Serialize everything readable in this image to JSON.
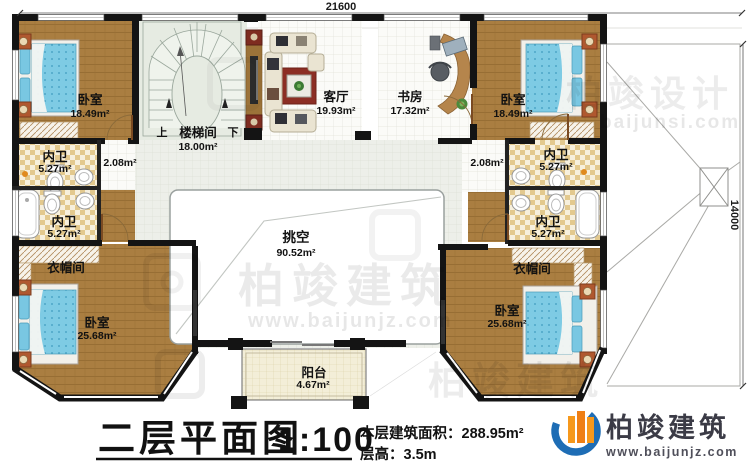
{
  "dimensions": {
    "top": "21600",
    "right": "14000"
  },
  "rooms": {
    "bedroom_tl": {
      "name": "卧室",
      "area": "18.49m²"
    },
    "bedroom_tr": {
      "name": "卧室",
      "area": "18.49m²"
    },
    "bedroom_bl": {
      "name": "卧室",
      "area": "25.68m²"
    },
    "bedroom_br": {
      "name": "卧室",
      "area": "25.68m²"
    },
    "stairwell": {
      "name": "楼梯间",
      "area": "18.00m²",
      "up": "上",
      "down": "下"
    },
    "living": {
      "name": "客厅",
      "area": "19.93m²"
    },
    "study": {
      "name": "书房",
      "area": "17.32m²"
    },
    "bath_tl": {
      "name": "内卫",
      "area": "5.27m²"
    },
    "bath_bl": {
      "name": "内卫",
      "area": "5.27m²"
    },
    "bath_tr": {
      "name": "内卫",
      "area": "5.27m²"
    },
    "bath_br": {
      "name": "内卫",
      "area": "5.27m²"
    },
    "hall_left": {
      "area": "2.08m²"
    },
    "hall_right": {
      "area": "2.08m²"
    },
    "cloak_left": {
      "name": "衣帽间"
    },
    "cloak_right": {
      "name": "衣帽间"
    },
    "void": {
      "name": "挑空",
      "area": "90.52m²"
    },
    "balcony": {
      "name": "阳台",
      "area": "4.67m²"
    }
  },
  "titleblock": {
    "title": "二层平面图",
    "scale": "1:100",
    "area_line": "本层建筑面积：288.95m²",
    "height_line": "层高：3.5m"
  },
  "logo": {
    "name": "柏竣建筑",
    "url": "www.baijunjz.com"
  },
  "watermarks": {
    "design_name": "柏竣设计",
    "design_url": "baijunsi.com",
    "build_name": "柏竣建筑",
    "build_url": "www.baijunjz.com"
  }
}
